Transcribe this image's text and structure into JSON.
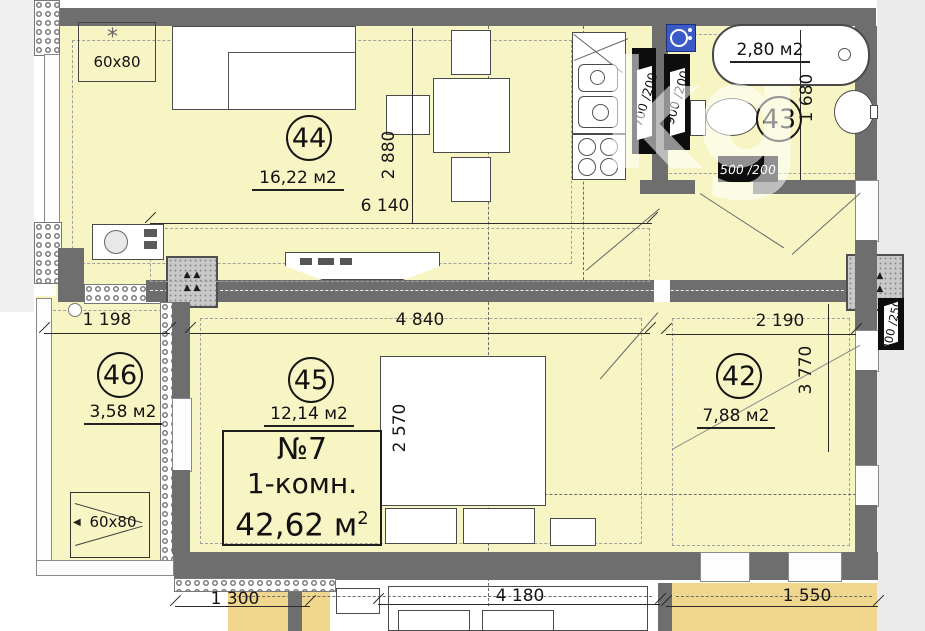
{
  "watermark": "kg",
  "apartment": {
    "number": "№7",
    "type": "1-комн.",
    "area_value": "42,62 м",
    "area_sup": "2"
  },
  "rooms": [
    {
      "num": "44",
      "area": "16,22 м2"
    },
    {
      "num": "43",
      "area": "2,80 м2"
    },
    {
      "num": "45",
      "area": "12,14 м2"
    },
    {
      "num": "46",
      "area": "3,58 м2"
    },
    {
      "num": "42",
      "area": "7,88 м2"
    }
  ],
  "dims": {
    "v2880": "2 880",
    "h6140": "6 140",
    "h1198": "1 198",
    "h4840": "4 840",
    "h2190": "2 190",
    "v3770": "3 770",
    "v2570": "2 570",
    "v1680": "1 680",
    "b1300": "1 300",
    "b4180": "4 180",
    "b1550": "1 550"
  },
  "vents": {
    "v700": "700 /200",
    "v900": "900 /200",
    "v500": "500 /200",
    "v400": "400 /250"
  },
  "markers": {
    "top": "60x80",
    "bottom": "60x80"
  },
  "icons": {
    "asterisk": "*",
    "arrow_left": "◀"
  },
  "colors": {
    "room_fill": "#f8f5c4",
    "neighbor_fill": "#f1d78e",
    "wall": "#6e6e6e",
    "fixture_blue": "#3a5bc7"
  }
}
